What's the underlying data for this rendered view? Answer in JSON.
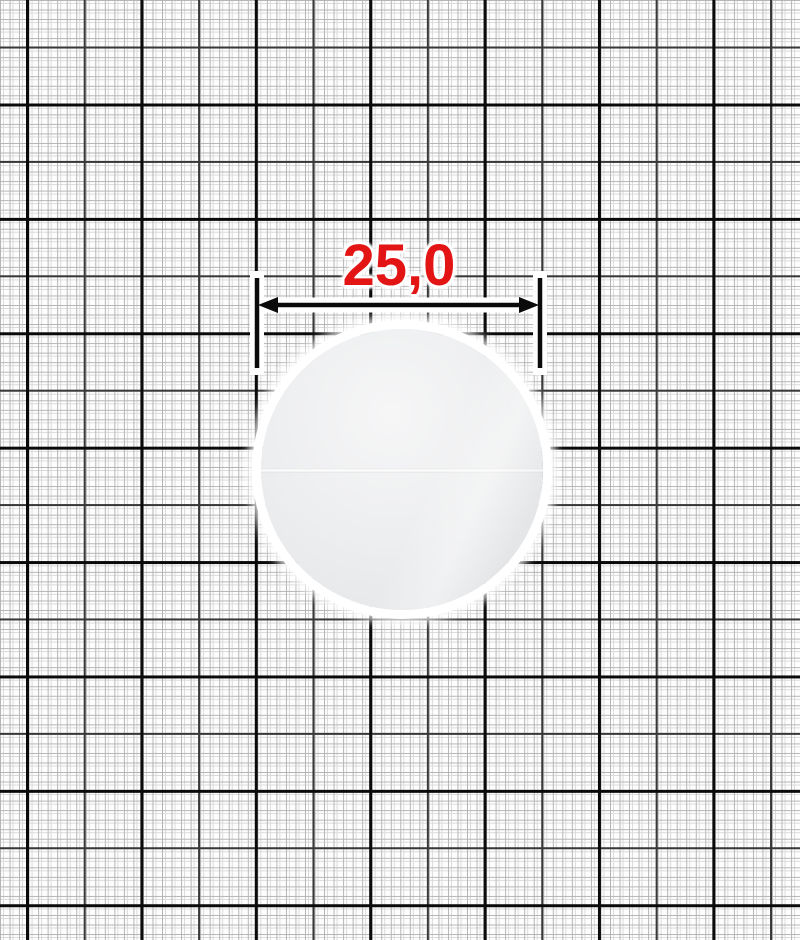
{
  "scene": {
    "type": "measured product photo on millimeter grid paper",
    "object": {
      "name": "round white plastic button",
      "shape": "circle",
      "surface_color": "#ebecee",
      "seam": "faint horizontal seam line across middle"
    }
  },
  "dimension": {
    "label": "25,0",
    "label_color": "#e31414",
    "line_color": "#0b0b0b",
    "halo_color": "#ffffff"
  },
  "grid": {
    "background_color": "#fdfdfd",
    "fine_line_color": "#b3b3b3",
    "medium_line_color": "#383838",
    "thick_line_color": "#0a0a0a"
  }
}
